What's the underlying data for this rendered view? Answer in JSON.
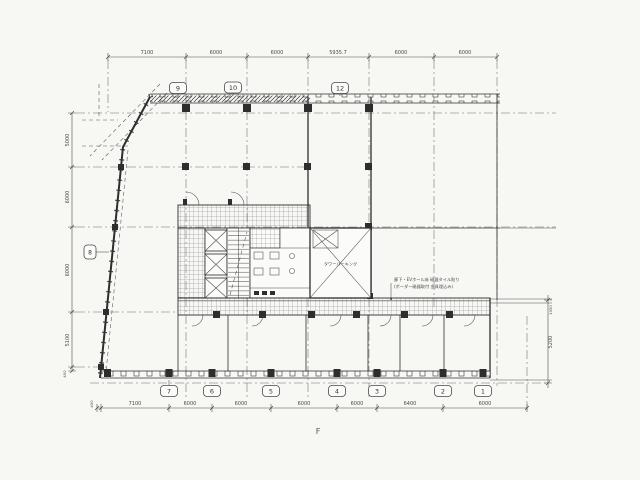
{
  "meta": {
    "figure_label": "F"
  },
  "grid_bubbles": {
    "top": [
      "9",
      "10",
      "12"
    ],
    "left": [
      "8"
    ],
    "bottom": [
      "7",
      "6",
      "5",
      "4",
      "3",
      "2",
      "1"
    ]
  },
  "dimensions": {
    "top": [
      "7100",
      "6000",
      "6000",
      "5935.7",
      "6000",
      "6000"
    ],
    "bottom": [
      "400",
      "7100",
      "6000",
      "6000",
      "6000",
      "6000",
      "6400",
      "6000"
    ],
    "left": [
      "5000",
      "6000",
      "6000",
      "5100",
      "400"
    ],
    "right": [
      "1050",
      "5200"
    ]
  },
  "labels": {
    "tower_parking": "タワーパーキング"
  },
  "annotation": {
    "line1": "廊下・EVホール床 磁器タイル貼り",
    "line2": "(ボーダー磁器取付 金具埋込み)"
  },
  "colors": {
    "paper": "#f7f7f4",
    "ink": "#2e2e2e",
    "faint": "#6a6a6a"
  }
}
